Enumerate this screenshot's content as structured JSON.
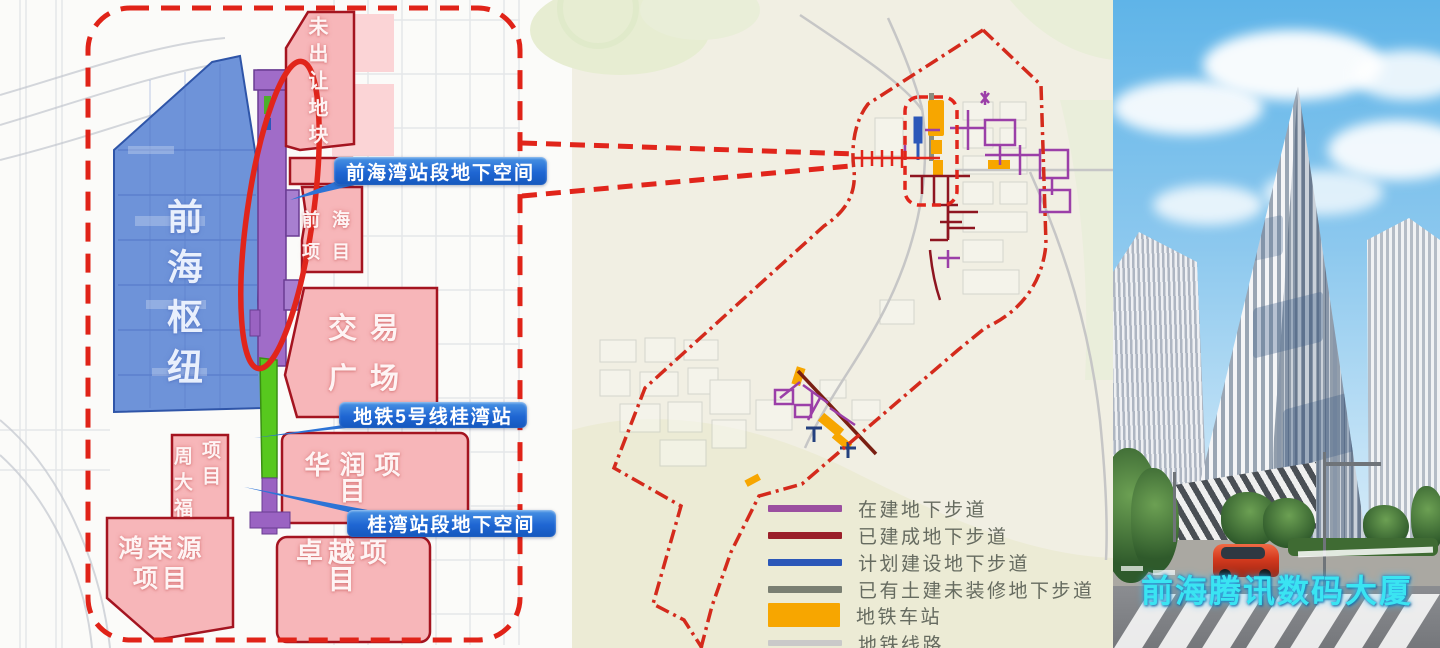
{
  "left_map": {
    "zones": {
      "hub": {
        "label": "前海枢纽",
        "fill": "#6e93d9"
      },
      "unsold": {
        "label": "未出让地块"
      },
      "qianhai_project": {
        "line1": "前海",
        "line2": "项目"
      },
      "trading_plaza": {
        "line1": "交易",
        "line2": "广场"
      },
      "chow_tai_fook": {
        "col1": "周大福",
        "col2": "项目"
      },
      "china_resources": {
        "label": "华润项目"
      },
      "hongrongyuan": {
        "line1": "鸿荣源",
        "line2": "项目"
      },
      "zhuoyue": {
        "label": "卓越项目"
      }
    },
    "callouts": {
      "qianhaiwan_station": "前海湾站段地下空间",
      "metro_line5_guiwan": "地铁5号线桂湾站",
      "guiwan_station": "桂湾站段地下空间"
    },
    "colors": {
      "boundary_red": "#e02318",
      "zone_pink": "#f7b6b9",
      "zone_pink_border": "#a41420",
      "hub_blue": "#6e93d9",
      "corridor_purple": "#a06cc8",
      "strip_green": "#57c81e",
      "callout_blue": "#2166d3"
    }
  },
  "middle_map": {
    "legend": [
      {
        "label": "在建地下步道",
        "color": "#9b4fa0",
        "shape": "line"
      },
      {
        "label": "已建成地下步道",
        "color": "#9a1f2a",
        "shape": "line"
      },
      {
        "label": "计划建设地下步道",
        "color": "#2b57b8",
        "shape": "line"
      },
      {
        "label": "已有土建未装修地下步道",
        "color": "#7a7f72",
        "shape": "line"
      },
      {
        "label": "地铁车站",
        "color": "#f7a600",
        "shape": "block"
      },
      {
        "label": "地铁线路",
        "color": "#c9c9c9",
        "shape": "line"
      }
    ],
    "colors": {
      "boundary": "#d42a1c",
      "station_orange": "#f7a600",
      "walkway_purple": "#9b3fa8",
      "walkway_built": "#8e1520",
      "walkway_planned": "#2b57b8",
      "metro_gray": "#c6c6c6"
    }
  },
  "photo": {
    "caption": "前海腾讯数码大厦",
    "caption_color": "#3ae4f2"
  }
}
